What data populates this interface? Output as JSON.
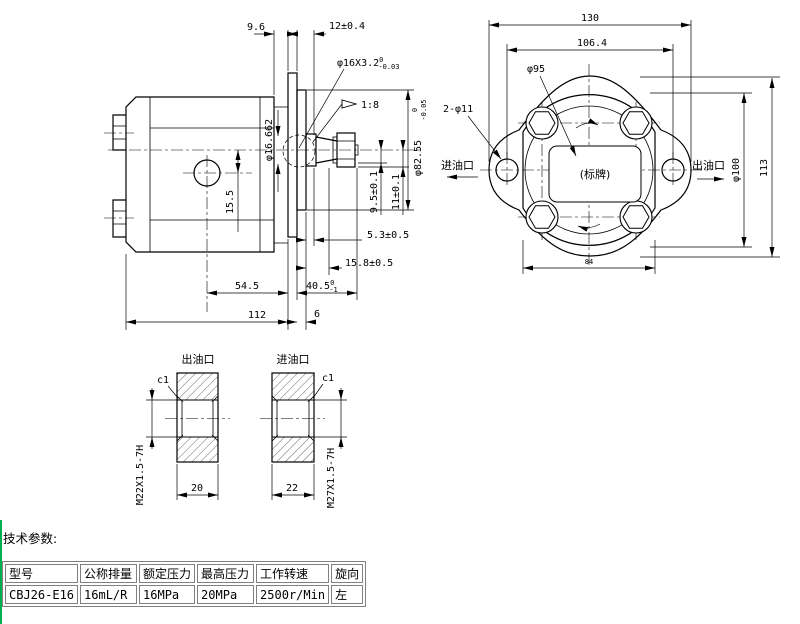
{
  "side_view": {
    "dim_9_6": "9.6",
    "dim_12": "12±0.4",
    "shaft_thread": {
      "main": "φ16X3.2",
      "tol_upper": "0",
      "tol_lower": "-0.03"
    },
    "taper_ratio": "1:8",
    "taper_gauge_dia": "φ16.662",
    "dim_15_5": "15.5",
    "dim_9_5": "9.5±0.1",
    "dim_11": "11±0.1",
    "spigot_dia": {
      "main": "φ82.55",
      "tol_upper": "0",
      "tol_lower": "-0.05"
    },
    "dim_5_3": "5.3±0.5",
    "dim_15_8": "15.8±0.5",
    "dim_54_5": "54.5",
    "dim_40_5": {
      "main": "40.5",
      "tol_upper": "0",
      "tol_lower": "-1"
    },
    "dim_112": "112",
    "dim_6": "6"
  },
  "front_view": {
    "dim_130": "130",
    "dim_106_4": "106.4",
    "dia_95": "φ95",
    "mount_holes": "2-φ11",
    "inlet_label": "进油口",
    "outlet_label": "出油口",
    "nameplate": "(标牌)",
    "dia_100": "φ100",
    "dim_113": "113",
    "dim_84": "84"
  },
  "sections": {
    "outlet": {
      "title": "出油口",
      "chamfer": "c1",
      "thread": "M22X1.5-7H",
      "bore_width": "20"
    },
    "inlet": {
      "title": "进油口",
      "chamfer": "c1",
      "thread": "M27X1.5-7H",
      "bore_width": "22"
    }
  },
  "tech_params": {
    "heading": "技术参数:",
    "headers": [
      "型号",
      "公称排量",
      "额定压力",
      "最高压力",
      "工作转速",
      "旋向"
    ],
    "values": [
      "CBJ26-E16",
      "16mL/R",
      "16MPa",
      "20MPa",
      "2500r/Min",
      "左"
    ]
  }
}
